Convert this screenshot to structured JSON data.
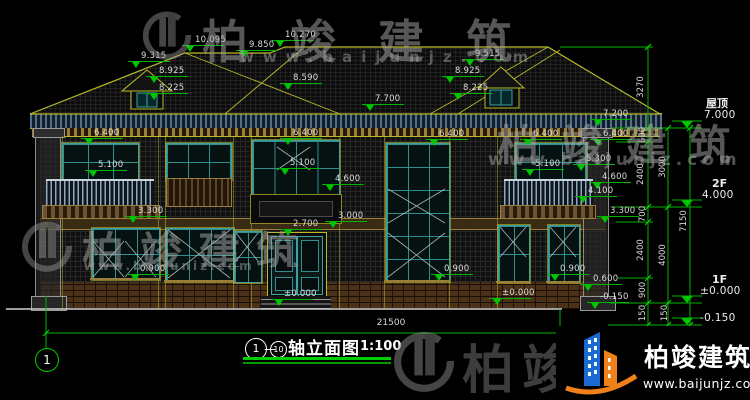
{
  "brand": {
    "name": "柏竣建筑",
    "url": "www.baijunjz.com"
  },
  "title_block": {
    "axis_start": "1",
    "axis_end": "10",
    "dash": "—",
    "name": "轴立面图",
    "scale": "1:100"
  },
  "axis_bubble_label": "1",
  "dimensions": {
    "bottom_total": {
      "text": "21500",
      "x": 391,
      "y": 319
    },
    "vertical": [
      {
        "t": "3270",
        "x": 641,
        "y": 87
      },
      {
        "t": "600",
        "x": 643,
        "y": 135
      },
      {
        "t": "2400",
        "x": 641,
        "y": 174
      },
      {
        "t": "700",
        "x": 643,
        "y": 214
      },
      {
        "t": "2400",
        "x": 641,
        "y": 250
      },
      {
        "t": "900",
        "x": 643,
        "y": 290
      },
      {
        "t": "150",
        "x": 643,
        "y": 313
      },
      {
        "t": "3000",
        "x": 663,
        "y": 167
      },
      {
        "t": "4000",
        "x": 663,
        "y": 255
      },
      {
        "t": "150",
        "x": 665,
        "y": 313
      },
      {
        "t": "7150",
        "x": 684,
        "y": 221
      }
    ]
  },
  "levels": [
    {
      "label": "屋顶",
      "value": "7.000",
      "lx": 706,
      "ly": 98,
      "vx": 704,
      "vy": 110,
      "line_y": 128
    },
    {
      "label": "2F",
      "value": "4.000",
      "lx": 712,
      "ly": 178,
      "vx": 702,
      "vy": 190,
      "line_y": 207
    },
    {
      "label": "1F",
      "value": "±0.000",
      "lx": 712,
      "ly": 274,
      "vx": 700,
      "vy": 286,
      "line_y": 303
    },
    {
      "label": "",
      "value": "-0.150",
      "lx": 0,
      "ly": 0,
      "vx": 700,
      "vy": 313,
      "line_y": 325
    }
  ],
  "elevation_markers": [
    {
      "t": "9.315",
      "x": 141,
      "y": 52
    },
    {
      "t": "10.095",
      "x": 195,
      "y": 36
    },
    {
      "t": "9.850",
      "x": 249,
      "y": 41
    },
    {
      "t": "10.270",
      "x": 285,
      "y": 31
    },
    {
      "t": "8.925",
      "x": 159,
      "y": 67
    },
    {
      "t": "8.225",
      "x": 159,
      "y": 84
    },
    {
      "t": "8.590",
      "x": 293,
      "y": 74
    },
    {
      "t": "9.515",
      "x": 475,
      "y": 50
    },
    {
      "t": "8.925",
      "x": 455,
      "y": 67
    },
    {
      "t": "8.225",
      "x": 463,
      "y": 84
    },
    {
      "t": "7.700",
      "x": 375,
      "y": 95
    },
    {
      "t": "7.200",
      "x": 603,
      "y": 110
    },
    {
      "t": "6.400",
      "x": 94,
      "y": 129
    },
    {
      "t": "6.400",
      "x": 293,
      "y": 129
    },
    {
      "t": "6.400",
      "x": 439,
      "y": 130
    },
    {
      "t": "6.400",
      "x": 533,
      "y": 130
    },
    {
      "t": "6.400",
      "x": 603,
      "y": 130
    },
    {
      "t": "5.100",
      "x": 98,
      "y": 161
    },
    {
      "t": "5.100",
      "x": 290,
      "y": 159
    },
    {
      "t": "5.100",
      "x": 535,
      "y": 160
    },
    {
      "t": "5.300",
      "x": 586,
      "y": 155
    },
    {
      "t": "4.600",
      "x": 335,
      "y": 175
    },
    {
      "t": "4.600",
      "x": 602,
      "y": 173
    },
    {
      "t": "4.100",
      "x": 588,
      "y": 187
    },
    {
      "t": "3.300",
      "x": 138,
      "y": 207
    },
    {
      "t": "3.000",
      "x": 338,
      "y": 212
    },
    {
      "t": "3.300",
      "x": 610,
      "y": 207
    },
    {
      "t": "2.700",
      "x": 293,
      "y": 220
    },
    {
      "t": "0.900",
      "x": 140,
      "y": 265
    },
    {
      "t": "0.900",
      "x": 444,
      "y": 265
    },
    {
      "t": "0.900",
      "x": 560,
      "y": 265
    },
    {
      "t": "0.600",
      "x": 593,
      "y": 275
    },
    {
      "t": "±0.000",
      "x": 284,
      "y": 290
    },
    {
      "t": "±0.000",
      "x": 502,
      "y": 289
    },
    {
      "t": "-0.150",
      "x": 600,
      "y": 293
    }
  ],
  "colors": {
    "cad_line_yellow": "#b9b92a",
    "cad_green": "#00c800",
    "window_teal": "#3fa0a0",
    "logo_blue": "#1a6ad4",
    "logo_orange": "#f08018"
  }
}
